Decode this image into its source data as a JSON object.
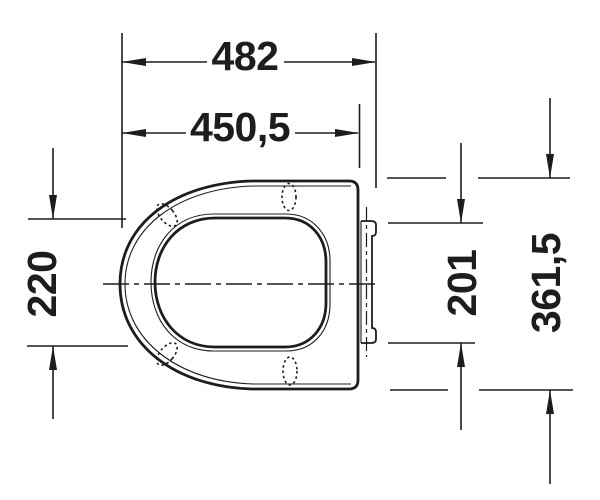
{
  "colors": {
    "line": "#1d1d1b",
    "background": "#ffffff"
  },
  "dimensions": {
    "width_overall": "482",
    "width_seat": "450,5",
    "height_left": "220",
    "height_hinge": "201",
    "height_overall": "361,5"
  }
}
